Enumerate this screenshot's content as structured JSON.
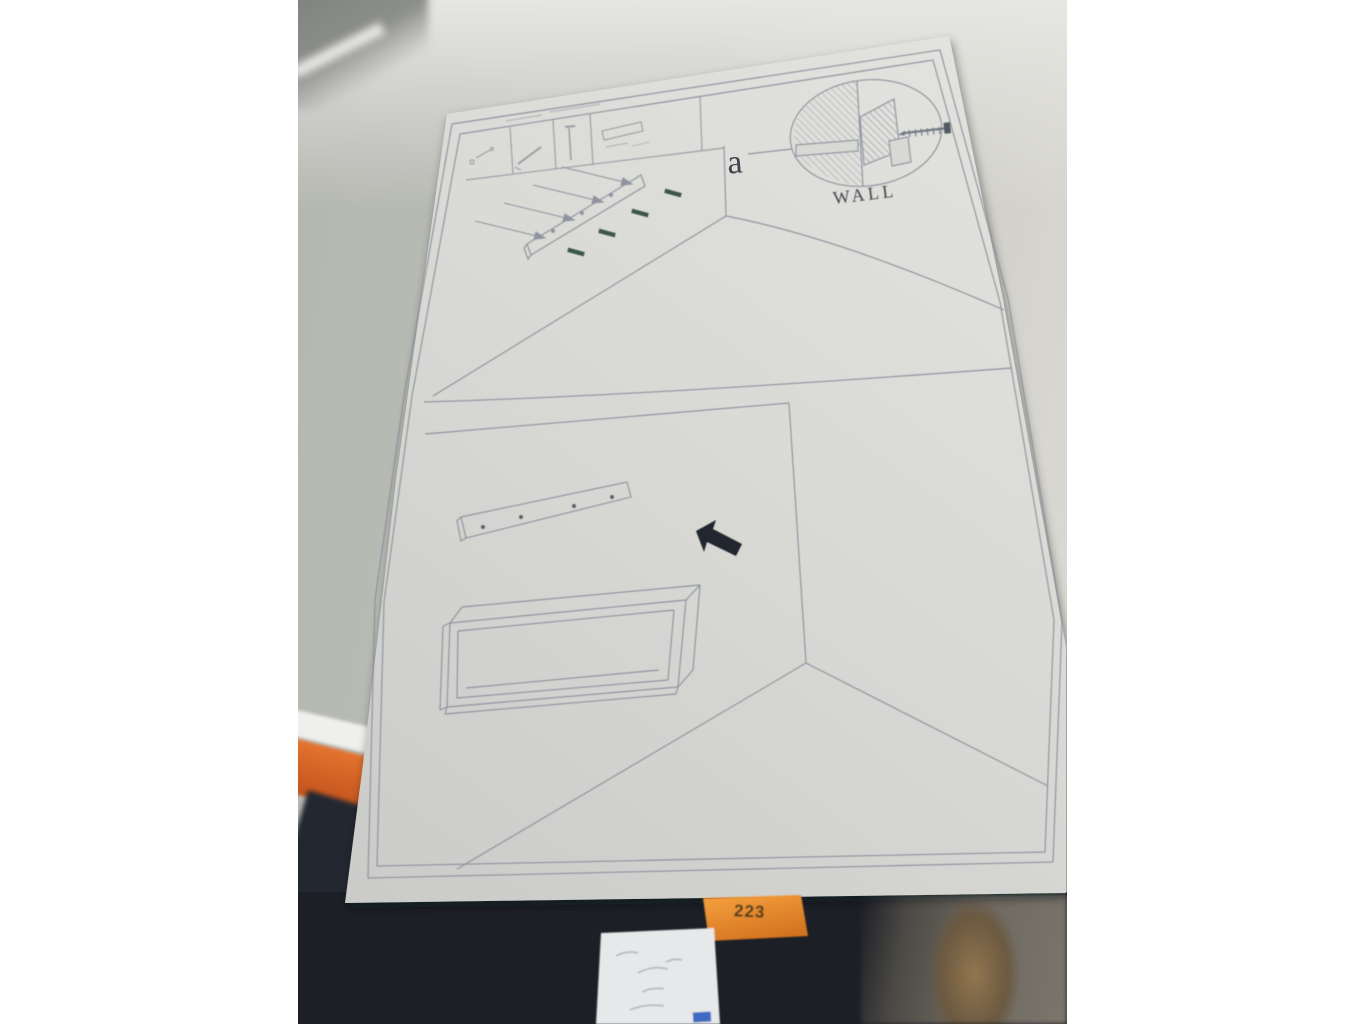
{
  "photo": {
    "subject": "furniture wall-mounting assembly instruction sheet photographed in front of a wall",
    "instruction_sheet": {
      "step_label": "a",
      "wall_label": "WALL",
      "header_icons": [
        "dowel-hardware-icon",
        "screwdriver-icon",
        "screw-icon",
        "bracket-plate-icon"
      ],
      "figures": [
        {
          "name": "mounting-rail-with-screws",
          "screw_count": 4
        },
        {
          "name": "wall-anchor-callout",
          "label": "WALL"
        },
        {
          "name": "drilled-mounting-rail",
          "hole_count": 4
        },
        {
          "name": "direction-arrow"
        },
        {
          "name": "open-shelf-box"
        }
      ]
    },
    "sticky_note": {
      "text": "223",
      "color": "#e58426"
    },
    "white_note": {
      "description": "handwritten note, illegible"
    },
    "colors": {
      "wall": "#bcbeb8",
      "paper": "#d9d9d6",
      "print_line": "#8a909b",
      "screw_green": "#3c564b",
      "arrow_black": "#24272e",
      "surface_dark": "#1d1f26",
      "ledge_orange": "#d9632a"
    }
  }
}
